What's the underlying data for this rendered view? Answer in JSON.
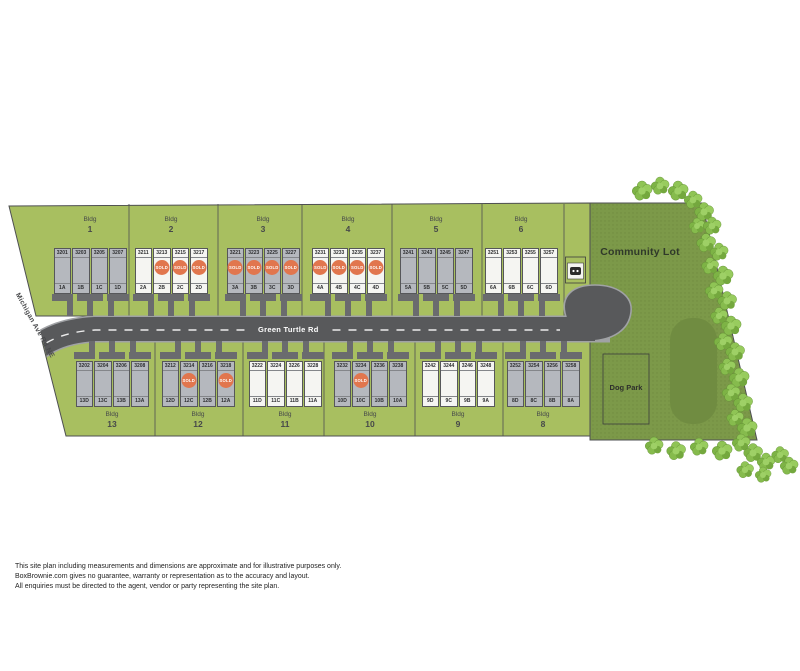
{
  "labels": {
    "road": "Green Turtle Rd",
    "side_road": "Michigan Ave Rd NE",
    "community_lot": "Community Lot",
    "dog_park": "Dog Park",
    "bldg_prefix": "Bldg",
    "sold": "SOLD"
  },
  "colors": {
    "site_green": "#a8bf60",
    "community_green": "#7c9949",
    "pond_green": "#708c41",
    "road_gray": "#58595b",
    "road_edge_gray": "#a0a2a5",
    "building_gray": "#6a6b6e",
    "unit_gray": "#b5b8be",
    "unit_white": "#f5f5f2",
    "sold_orange": "#e1764e"
  },
  "buildings": {
    "top": [
      {
        "name": "1",
        "units": [
          {
            "number": "3201",
            "unit": "1A",
            "style": "gray",
            "sold": false
          },
          {
            "number": "3203",
            "unit": "1B",
            "style": "gray",
            "sold": false
          },
          {
            "number": "3205",
            "unit": "1C",
            "style": "gray",
            "sold": false
          },
          {
            "number": "3207",
            "unit": "1D",
            "style": "gray",
            "sold": false
          }
        ]
      },
      {
        "name": "2",
        "units": [
          {
            "number": "3211",
            "unit": "2A",
            "style": "white",
            "sold": false
          },
          {
            "number": "3213",
            "unit": "2B",
            "style": "white",
            "sold": true
          },
          {
            "number": "3215",
            "unit": "2C",
            "style": "white",
            "sold": true
          },
          {
            "number": "3217",
            "unit": "2D",
            "style": "white",
            "sold": true
          }
        ]
      },
      {
        "name": "3",
        "units": [
          {
            "number": "3221",
            "unit": "3A",
            "style": "gray",
            "sold": true
          },
          {
            "number": "3223",
            "unit": "3B",
            "style": "gray",
            "sold": true
          },
          {
            "number": "3225",
            "unit": "3C",
            "style": "gray",
            "sold": true
          },
          {
            "number": "3227",
            "unit": "3D",
            "style": "gray",
            "sold": true
          }
        ]
      },
      {
        "name": "4",
        "units": [
          {
            "number": "3231",
            "unit": "4A",
            "style": "white",
            "sold": true
          },
          {
            "number": "3233",
            "unit": "4B",
            "style": "white",
            "sold": true
          },
          {
            "number": "3235",
            "unit": "4C",
            "style": "white",
            "sold": true
          },
          {
            "number": "3237",
            "unit": "4D",
            "style": "white",
            "sold": true
          }
        ]
      },
      {
        "name": "5",
        "units": [
          {
            "number": "3241",
            "unit": "5A",
            "style": "gray",
            "sold": false
          },
          {
            "number": "3243",
            "unit": "5B",
            "style": "gray",
            "sold": false
          },
          {
            "number": "3245",
            "unit": "5C",
            "style": "gray",
            "sold": false
          },
          {
            "number": "3247",
            "unit": "5D",
            "style": "gray",
            "sold": false
          }
        ]
      },
      {
        "name": "6",
        "units": [
          {
            "number": "3251",
            "unit": "6A",
            "style": "white",
            "sold": false
          },
          {
            "number": "3253",
            "unit": "6B",
            "style": "white",
            "sold": false
          },
          {
            "number": "3255",
            "unit": "6C",
            "style": "white",
            "sold": false
          },
          {
            "number": "3257",
            "unit": "6D",
            "style": "white",
            "sold": false
          }
        ]
      }
    ],
    "bottom": [
      {
        "name": "13",
        "units": [
          {
            "number": "3202",
            "unit": "13D",
            "style": "gray",
            "sold": false
          },
          {
            "number": "3204",
            "unit": "13C",
            "style": "gray",
            "sold": false
          },
          {
            "number": "3206",
            "unit": "13B",
            "style": "gray",
            "sold": false
          },
          {
            "number": "3208",
            "unit": "13A",
            "style": "gray",
            "sold": false
          }
        ]
      },
      {
        "name": "12",
        "units": [
          {
            "number": "3212",
            "unit": "12D",
            "style": "gray",
            "sold": false
          },
          {
            "number": "3214",
            "unit": "12C",
            "style": "gray",
            "sold": true
          },
          {
            "number": "3216",
            "unit": "12B",
            "style": "gray",
            "sold": false
          },
          {
            "number": "3218",
            "unit": "12A",
            "style": "gray",
            "sold": true
          }
        ]
      },
      {
        "name": "11",
        "units": [
          {
            "number": "3222",
            "unit": "11D",
            "style": "white",
            "sold": false
          },
          {
            "number": "3224",
            "unit": "11C",
            "style": "white",
            "sold": false
          },
          {
            "number": "3226",
            "unit": "11B",
            "style": "white",
            "sold": false
          },
          {
            "number": "3228",
            "unit": "11A",
            "style": "white",
            "sold": false
          }
        ]
      },
      {
        "name": "10",
        "units": [
          {
            "number": "3232",
            "unit": "10D",
            "style": "gray",
            "sold": false
          },
          {
            "number": "3234",
            "unit": "10C",
            "style": "gray",
            "sold": true
          },
          {
            "number": "3236",
            "unit": "10B",
            "style": "gray",
            "sold": false
          },
          {
            "number": "3238",
            "unit": "10A",
            "style": "gray",
            "sold": false
          }
        ]
      },
      {
        "name": "9",
        "units": [
          {
            "number": "3242",
            "unit": "9D",
            "style": "white",
            "sold": false
          },
          {
            "number": "3244",
            "unit": "9C",
            "style": "white",
            "sold": false
          },
          {
            "number": "3246",
            "unit": "9B",
            "style": "white",
            "sold": false
          },
          {
            "number": "3248",
            "unit": "9A",
            "style": "white",
            "sold": false
          }
        ]
      },
      {
        "name": "8",
        "units": [
          {
            "number": "3252",
            "unit": "8D",
            "style": "gray",
            "sold": false
          },
          {
            "number": "3254",
            "unit": "8C",
            "style": "gray",
            "sold": false
          },
          {
            "number": "3256",
            "unit": "8B",
            "style": "gray",
            "sold": false
          },
          {
            "number": "3258",
            "unit": "8A",
            "style": "gray",
            "sold": false
          }
        ]
      }
    ]
  },
  "disclaimer": [
    "This site plan including measurements and dimensions are approximate and for illustrative purposes only.",
    "BoxBrownie.com gives no guarantee, warranty or representation as to the accuracy and layout.",
    "All enquiries must be directed to the agent, vendor or party representing the site plan."
  ]
}
